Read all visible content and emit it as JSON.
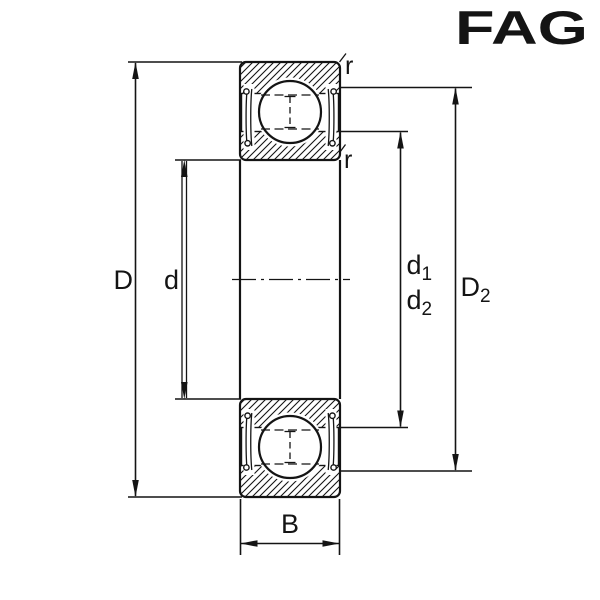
{
  "logo": {
    "text": "FAG",
    "color": "#D90F1C"
  },
  "drawing": {
    "type": "bearing-cross-section",
    "line_color": "#141414",
    "background_color": "#ffffff",
    "dimensions": {
      "outer_diameter": "D",
      "bore_diameter": "d",
      "d1": {
        "base": "d",
        "sub": "1"
      },
      "d2": {
        "base": "d",
        "sub": "2"
      },
      "D2": {
        "base": "D",
        "sub": "2"
      },
      "width": "B",
      "chamfer_top": "r",
      "chamfer_bottom": "r"
    }
  }
}
